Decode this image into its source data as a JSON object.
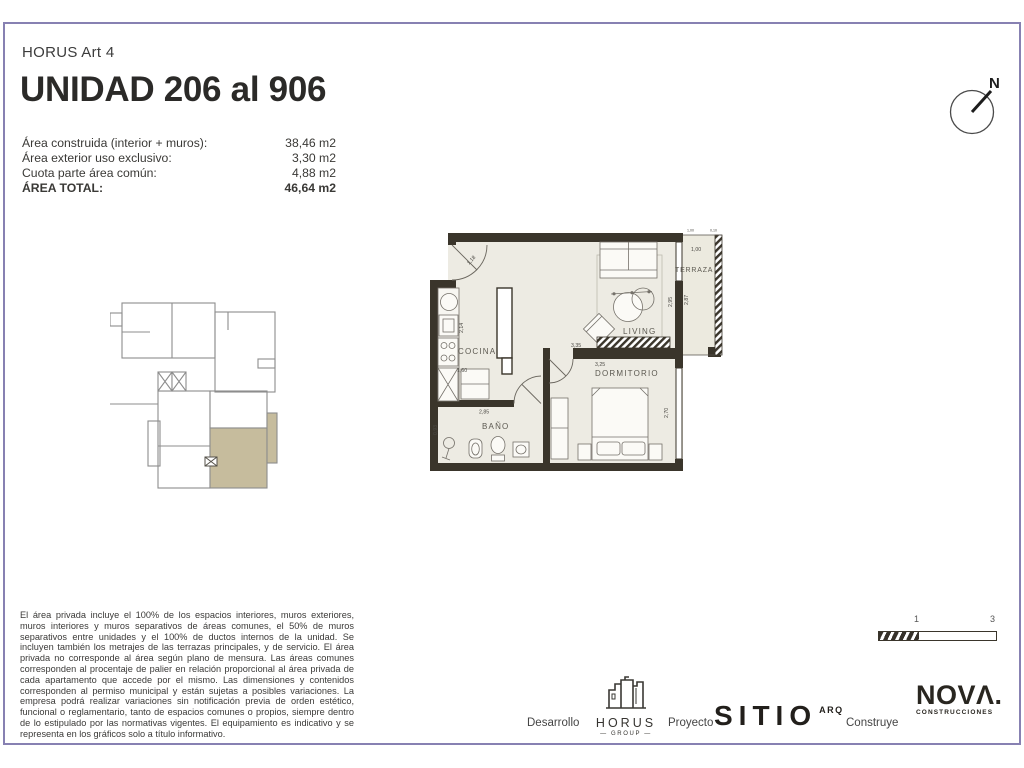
{
  "header": {
    "project": "HORUS Art 4",
    "title": "UNIDAD 206 al 906"
  },
  "areas": {
    "rows": [
      {
        "label": "Área construida (interior + muros):",
        "value": "38,46 m2"
      },
      {
        "label": "Área exterior uso exclusivo:",
        "value": "3,30 m2"
      },
      {
        "label": "Cuota parte área común:",
        "value": "4,88 m2"
      },
      {
        "label": "ÁREA TOTAL:",
        "value": "46,64 m2"
      }
    ]
  },
  "compass": {
    "north": "N"
  },
  "plan": {
    "rooms": {
      "cocina": "COCINA",
      "living": "LIVING",
      "terraza": "TERRAZA",
      "dormitorio": "DORMITORIO",
      "bano": "BAÑO"
    },
    "dims": {
      "entry": "1,18",
      "kitchen_height": "2,14",
      "kitchen_width": "1,60",
      "hall_width": "2,85",
      "bath_height": "0,93",
      "living_width": "3,35",
      "dorm_width": "3,25",
      "living_height": "2,95",
      "terraza_height": "2,87",
      "terraza_width": "1,00",
      "dorm_height": "2,70",
      "terraza_top": "1,00",
      "railing": "0,10"
    }
  },
  "legal": "El área privada incluye el 100% de los espacios interiores, muros exteriores, muros interiores y muros separativos de áreas comunes, el 50% de muros separativos entre unidades y el 100% de ductos internos de la unidad. Se incluyen también los metrajes de las terrazas principales, y de servicio. El área privada no corresponde al área según plano de mensura. Las áreas comunes corresponden al procentaje de palier en relación proporcional al área privada de cada apartamento que accede por el mismo. Las dimensiones y contenidos corresponden al permiso municipal y están sujetas a posibles variaciones. La empresa podrá realizar variaciones sin notificación previa de orden estético, funcional o reglamentario, tanto de espacios comunes o propios, siempre dentro de lo estipulado por las normativas vigentes. El equipamiento es indicativo y se representa en los gráficos solo a título informativo.",
  "scalebar": {
    "t1": "1",
    "t2": "3"
  },
  "footer": {
    "desarrollo": "Desarrollo",
    "horus_name": "HORUS",
    "horus_sub": "— GROUP —",
    "proyecto": "Proyecto",
    "sitio_name": "SITIO",
    "sitio_sub": "ARQ",
    "construye": "Construye",
    "nova_name": "NOVΛ.",
    "nova_sub": "CONSTRUCCIONES"
  },
  "colors": {
    "frame": "#8781b2",
    "wall": "#3a352b",
    "floor": "#edebe3",
    "unit_highlight": "#c6bc9d"
  }
}
